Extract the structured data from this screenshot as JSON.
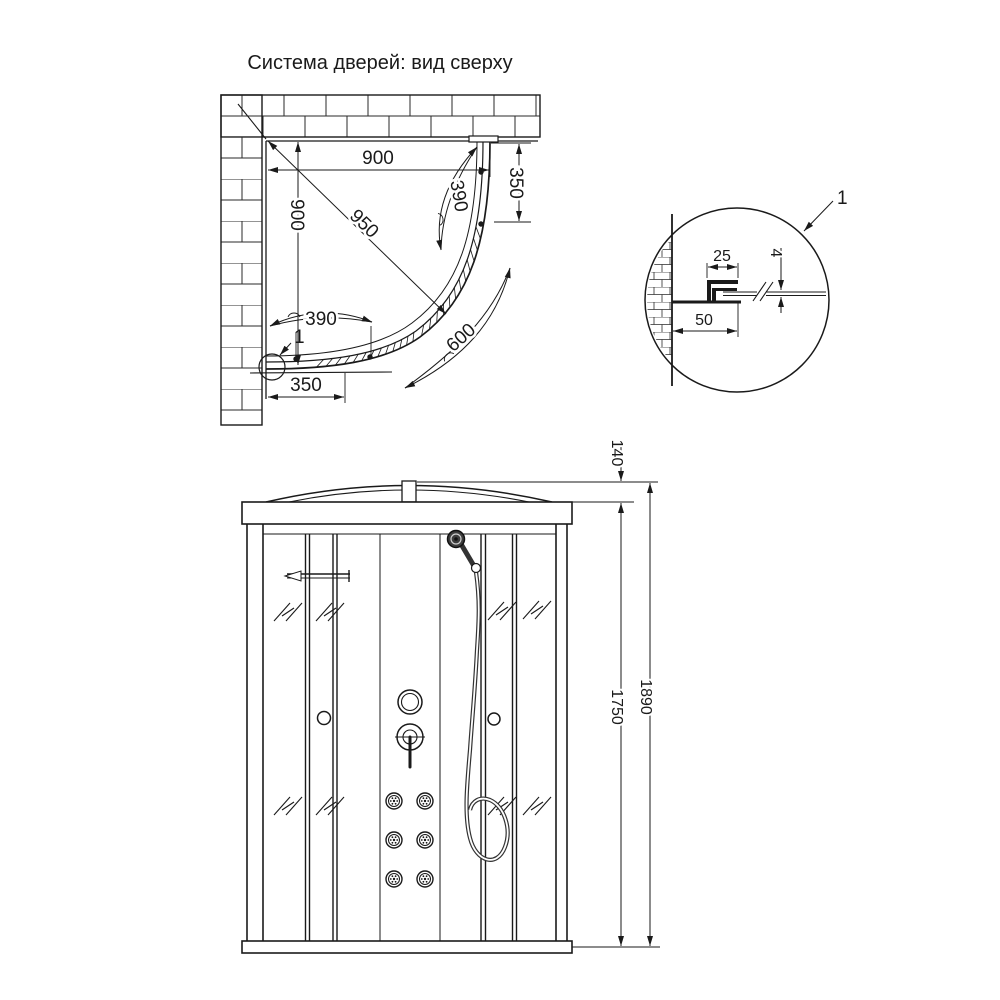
{
  "title": "Система дверей: вид сверху",
  "plan_view": {
    "dims": {
      "inner_width": "900",
      "inner_depth": "900",
      "diagonal": "950",
      "door_arc_right": "390",
      "door_arc_left": "390",
      "fixed_panel_right": "350",
      "fixed_panel_left": "350",
      "center_arc": "600"
    },
    "detail_marker": "1"
  },
  "detail_view": {
    "callout_label": "1",
    "dims": {
      "profile_width": "25",
      "glass_thickness": "4",
      "wall_clearance": "50"
    }
  },
  "front_view": {
    "dims": {
      "roof_height": "140",
      "cabin_height": "1750",
      "total_height": "1890"
    }
  }
}
